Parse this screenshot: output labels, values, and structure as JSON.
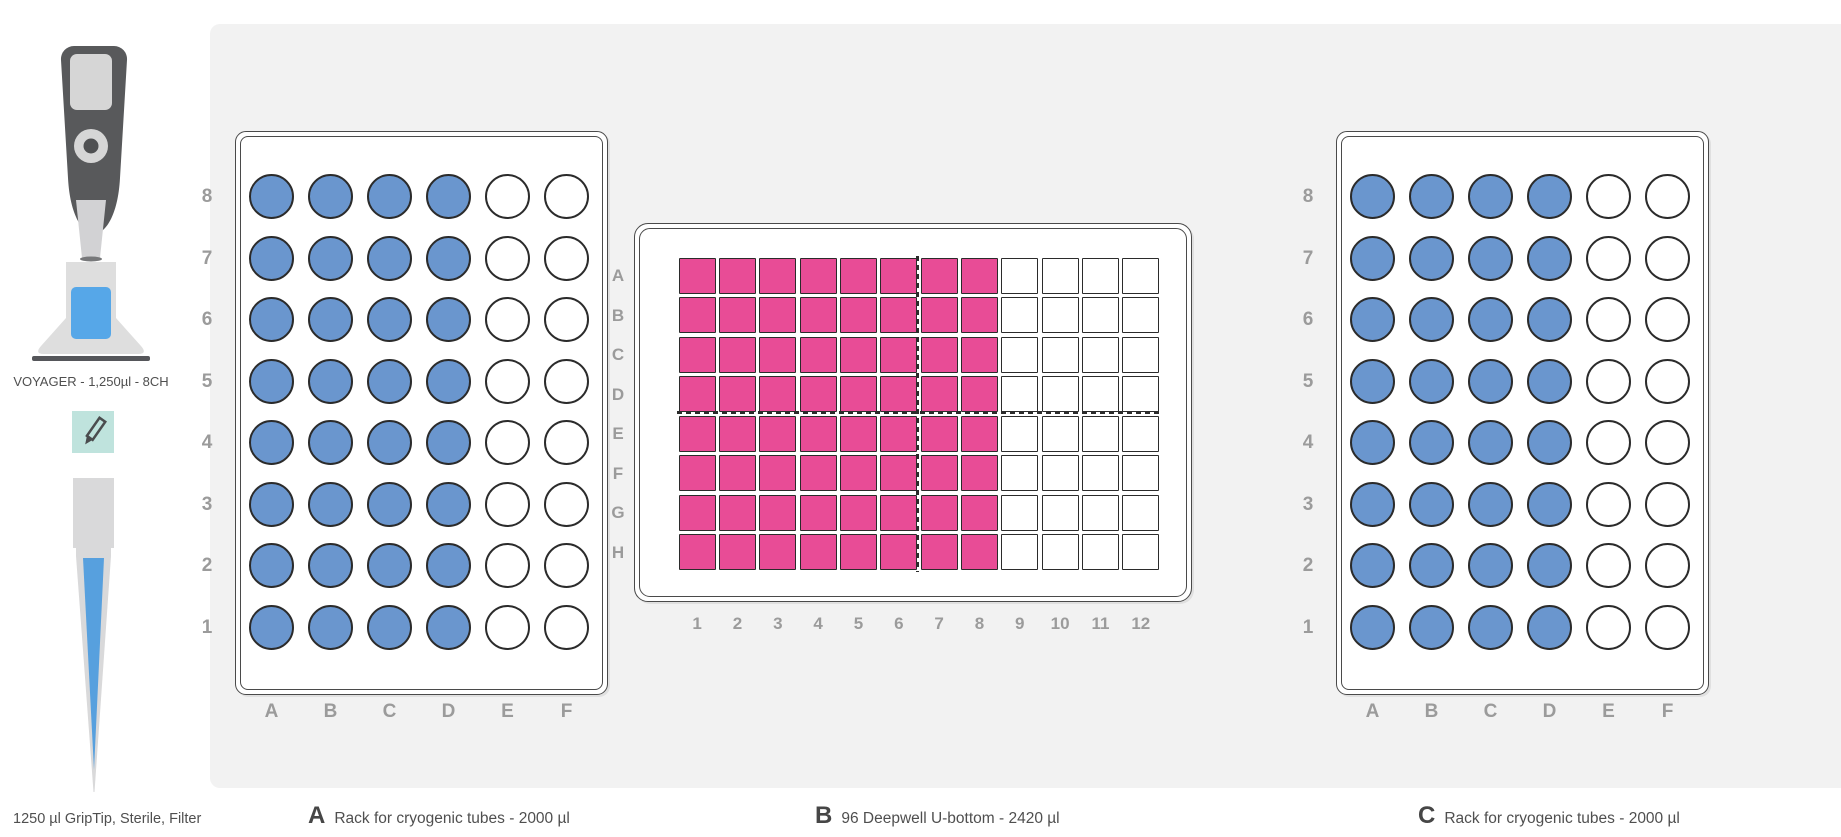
{
  "sidebar": {
    "pipette": {
      "label": "VOYAGER - 1,250µl - 8CH"
    },
    "tip": {
      "label": "1250 µl GripTip, Sterile, Filter"
    }
  },
  "colors": {
    "panel_bg": "#f2f2f2",
    "tube_filled": "#6a96ce",
    "well_filled": "#e84c96",
    "well_empty": "#ffffff",
    "well_border": "#2b2b2b",
    "label_gray": "#9b9b9b",
    "icon_teal": "#bfe3dd",
    "tip_blue": "#57a0de",
    "pad_blue": "#56a7e8",
    "pipette_dark": "#58595b",
    "pipette_light": "#d6d6d6"
  },
  "labware": [
    {
      "id": "A",
      "type": "tube-rack",
      "legend_letter": "A",
      "legend_text": "Rack for cryogenic tubes - 2000 µl",
      "row_labels": [
        "8",
        "7",
        "6",
        "5",
        "4",
        "3",
        "2",
        "1"
      ],
      "col_labels": [
        "A",
        "B",
        "C",
        "D",
        "E",
        "F"
      ],
      "filled_cols": 4
    },
    {
      "id": "B",
      "type": "deepwell-plate",
      "legend_letter": "B",
      "legend_text": "96 Deepwell U-bottom - 2420 µl",
      "row_labels": [
        "A",
        "B",
        "C",
        "D",
        "E",
        "F",
        "G",
        "H"
      ],
      "col_labels": [
        "1",
        "2",
        "3",
        "4",
        "5",
        "6",
        "7",
        "8",
        "9",
        "10",
        "11",
        "12"
      ],
      "filled_cols": 8
    },
    {
      "id": "C",
      "type": "tube-rack",
      "legend_letter": "C",
      "legend_text": "Rack for cryogenic tubes - 2000 µl",
      "row_labels": [
        "8",
        "7",
        "6",
        "5",
        "4",
        "3",
        "2",
        "1"
      ],
      "col_labels": [
        "A",
        "B",
        "C",
        "D",
        "E",
        "F"
      ],
      "filled_cols": 4
    }
  ]
}
